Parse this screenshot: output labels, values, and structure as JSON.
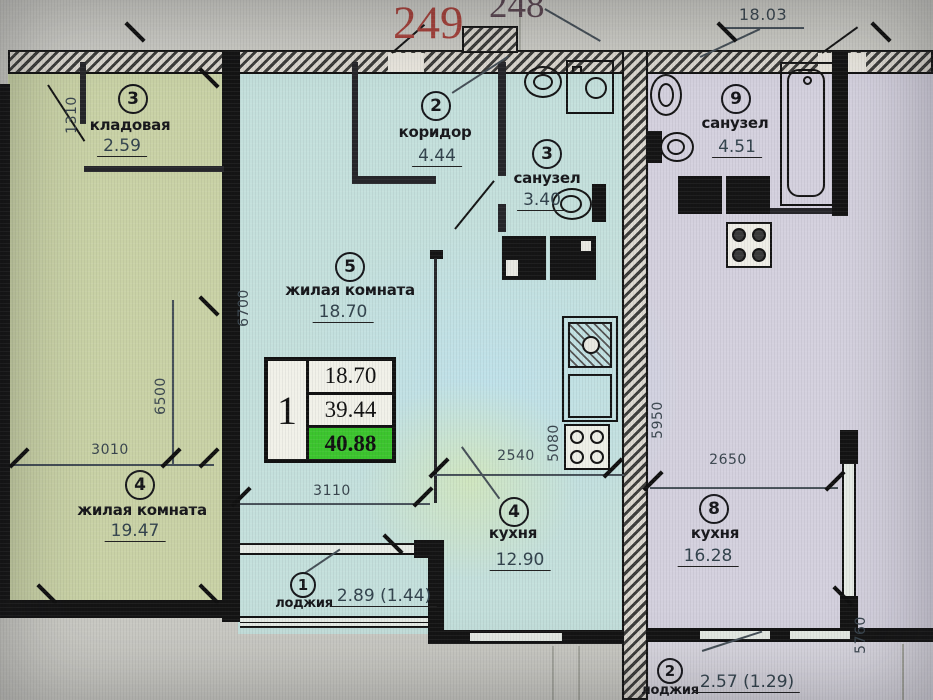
{
  "header": {
    "unit_number_primary": "249",
    "unit_number_secondary": "248",
    "adjacent_room_area": "18.03"
  },
  "stamp": {
    "unit": "1",
    "living_area": "18.70",
    "reduced_total_area": "39.44",
    "total_area": "40.88"
  },
  "rooms": {
    "storage_left": {
      "number": "3",
      "name": "кладовая",
      "area": "2.59"
    },
    "living_left": {
      "number": "4",
      "name": "жилая комната",
      "area": "19.47"
    },
    "corridor": {
      "number": "2",
      "name": "коридор",
      "area": "4.44"
    },
    "bathroom_mid": {
      "number": "3",
      "name": "санузел",
      "area": "3.40"
    },
    "living_mid": {
      "number": "5",
      "name": "жилая комната",
      "area": "18.70"
    },
    "kitchen_mid": {
      "number": "4",
      "name": "кухня",
      "area": "12.90"
    },
    "loggia_mid": {
      "number": "1",
      "name": "лоджия",
      "area": "2.89 (1.44)"
    },
    "bathroom_right": {
      "number": "9",
      "name": "санузел",
      "area": "4.51"
    },
    "kitchen_right": {
      "number": "8",
      "name": "кухня",
      "area": "16.28"
    },
    "loggia_right": {
      "number": "2",
      "name": "лоджия",
      "area": "2.57 (1.29)"
    }
  },
  "dimensions": {
    "d1310": "1310",
    "d6700": "6700",
    "d6500": "6500",
    "d3010": "3010",
    "d3110": "3110",
    "d2540": "2540",
    "d5080": "5080",
    "d5950": "5950",
    "d2650": "2650",
    "d5760": "5760"
  },
  "colors": {
    "left_apartment_fill": "#c9d2a6",
    "middle_apartment_fill": "#c4e0dc",
    "right_apartment_fill": "#d4d1de",
    "wall": "#141414",
    "unit_number_red": "#a8423b",
    "total_area_highlight": "#3cc52e"
  },
  "icons": {
    "fixtures": [
      "sink-icon",
      "washing-machine-icon",
      "toilet-icon",
      "bathtub-icon",
      "stove-icon",
      "kitchen-sink-icon",
      "vent-shaft-icon"
    ]
  }
}
